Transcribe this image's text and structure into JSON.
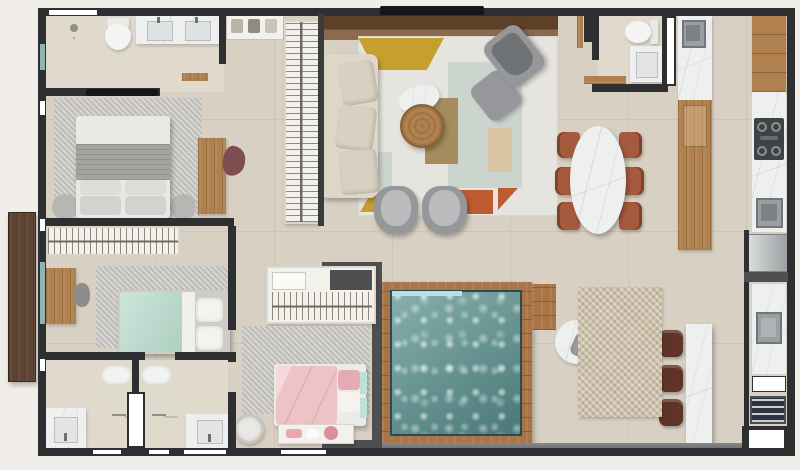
{
  "plan": {
    "name": "apartment-floor-plan-top-view",
    "render_style": "3d-rendered-floor-plan"
  },
  "palette": {
    "outside": "#f1eee9",
    "wall": "#2e2f30",
    "wall_gray": "#4d4f51",
    "floor": "#d8d0c2",
    "floor_light": "#e0dacd",
    "terrace": "#75787b",
    "entry_wood": "#5d4332",
    "wood": "#b0814e",
    "wood_dark": "#7c5536",
    "deck": "#a87448",
    "marble": "#eef0f0",
    "steel": "#9aa0a2",
    "fridge": "#b3b7b9",
    "water": "#6fa09d",
    "water_edge": "#b5dfe0",
    "rug_gray": "#c8c6c2",
    "rug_living": "#e6e4de",
    "rug_beige": "#ccc0aa",
    "sofa": "#ded7c7",
    "chair_gray": "#95979a",
    "bed_gray": "#a6a4a1",
    "bed_white": "#e9e8e4",
    "bed_mint": "#bcdcce",
    "bed_pink": "#eec3c7",
    "pillow_pink": "#e5abb4",
    "chair_mauve": "#7d4e50",
    "chair_terracotta": "#a55a3e",
    "stool_leather": "#5f3327",
    "closet_white": "#f2f1ec",
    "mustard": "#c6a02f",
    "rust": "#bf5b31",
    "sage": "#ccd4ce",
    "tan": "#d9c6a2",
    "brown_olive": "#a68b5d"
  },
  "rooms": [
    {
      "name": "master-bathroom"
    },
    {
      "name": "master-bedroom"
    },
    {
      "name": "master-closet"
    },
    {
      "name": "second-bedroom"
    },
    {
      "name": "bathroom-left"
    },
    {
      "name": "bathroom-right"
    },
    {
      "name": "third-bedroom"
    },
    {
      "name": "living-room"
    },
    {
      "name": "dining-area"
    },
    {
      "name": "powder-room"
    },
    {
      "name": "kitchen"
    },
    {
      "name": "laundry-area"
    },
    {
      "name": "pool-terrace"
    }
  ]
}
